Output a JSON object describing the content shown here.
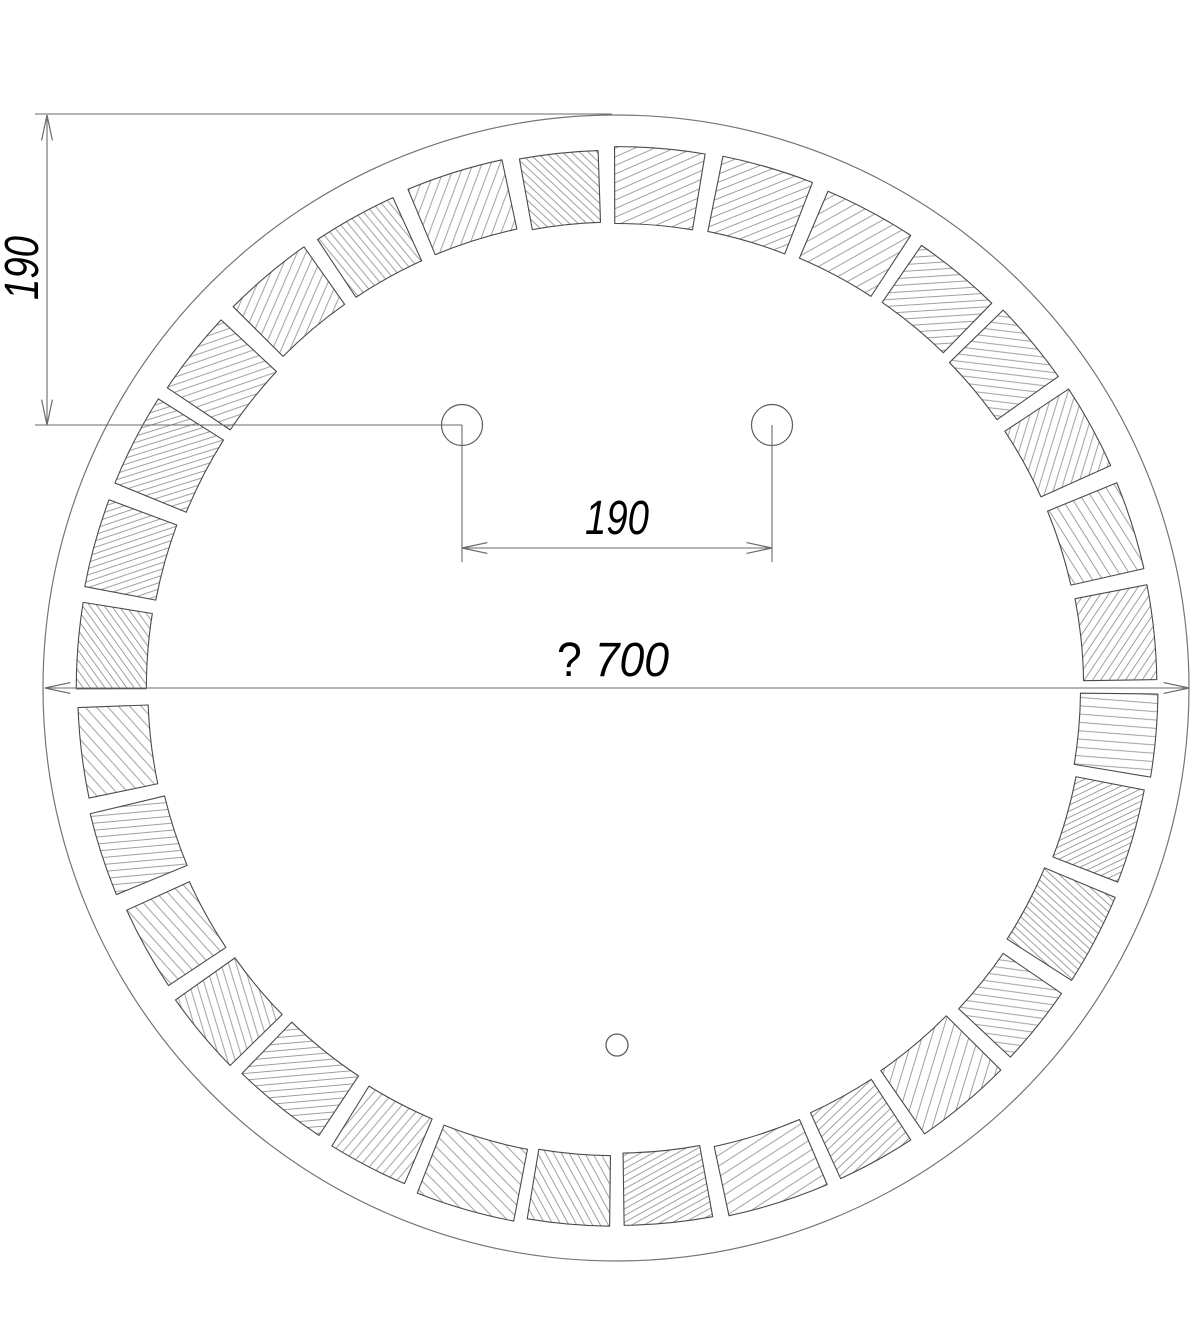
{
  "drawing": {
    "title": "round-mosaic-mirror-technical-drawing",
    "background_color": "#ffffff",
    "line_color": "#4a4a4a",
    "circle_color": "#757575",
    "hatch_color": "#8f8f8f",
    "dim_color": "#6a6a6a",
    "text_color": "#000000",
    "canvas": {
      "width": 1200,
      "height": 1317
    },
    "ring": {
      "cx": 616,
      "cy": 688,
      "outer_circle_r": 573,
      "tile_outer_r": 540,
      "tile_inner_r": 467,
      "tile_count": 32,
      "period_deg": 11.25,
      "first_gap_center_deg": 90.6,
      "gap_half_deg": 0.85
    },
    "holes": {
      "left": {
        "cx": 462,
        "cy": 425,
        "r": 20.5
      },
      "right": {
        "cx": 772,
        "cy": 425,
        "r": 20.5
      },
      "bottom": {
        "cx": 617,
        "cy": 1045,
        "r": 11
      }
    },
    "dimensions": {
      "vertical": {
        "label": "190",
        "dim_x": 47,
        "y_top": 115,
        "y_bottom": 425,
        "ext_top": {
          "x1": 35,
          "x2": 612,
          "y": 114
        },
        "ext_bottom": {
          "x1": 35,
          "x2": 462,
          "y": 425
        },
        "text": {
          "x": 38,
          "y": 268,
          "length": 64
        }
      },
      "hole_spacing": {
        "label": "190",
        "y": 548,
        "x_left": 462,
        "x_right": 772,
        "drop_to_y": 562,
        "text": {
          "x": 617,
          "y": 534,
          "length": 64
        }
      },
      "diameter": {
        "prefix": "?",
        "value": "700",
        "y": 688,
        "x_left": 45,
        "x_right": 1189,
        "text": {
          "x": 613,
          "y": 676,
          "length": 112
        }
      }
    },
    "arrow": {
      "length": 26,
      "half_angle_deg": 12
    },
    "text_style": {
      "font_size": 48
    }
  }
}
